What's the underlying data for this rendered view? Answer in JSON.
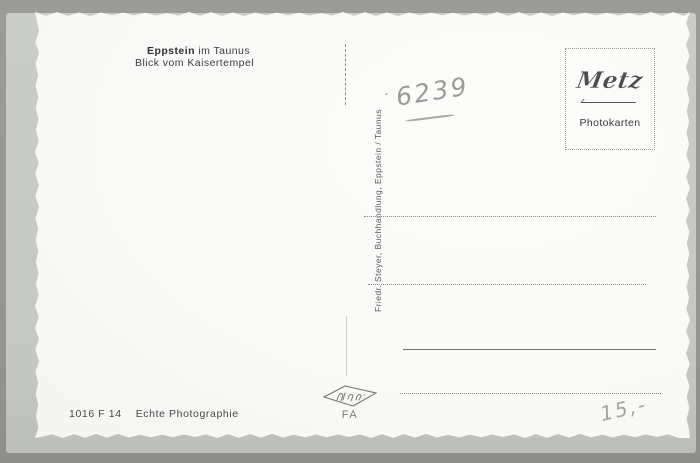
{
  "colors": {
    "background": "#969793",
    "under_card": "#c7c9c4",
    "card": "#fbfbf9",
    "printed_ink": "#3c3c3c",
    "pencil": "#9b9c9a",
    "line_dotted": "#8a8a87"
  },
  "postcard": {
    "caption": {
      "title_bold": "Eppstein",
      "title_rest": "im Taunus",
      "subtitle": "Blick vom Kaisertempel"
    },
    "handwriting": {
      "dot": "·",
      "number": "6239",
      "price": "15,-"
    },
    "stamp_box": {
      "brand": "Metz",
      "caption": "Photokarten"
    },
    "publisher": "Friedr. Steyer, Buchhandlung, Eppstein / Taunus",
    "footer": {
      "code": "1016 F 14",
      "label": "Echte Photographie",
      "printer_code": "FA"
    }
  }
}
